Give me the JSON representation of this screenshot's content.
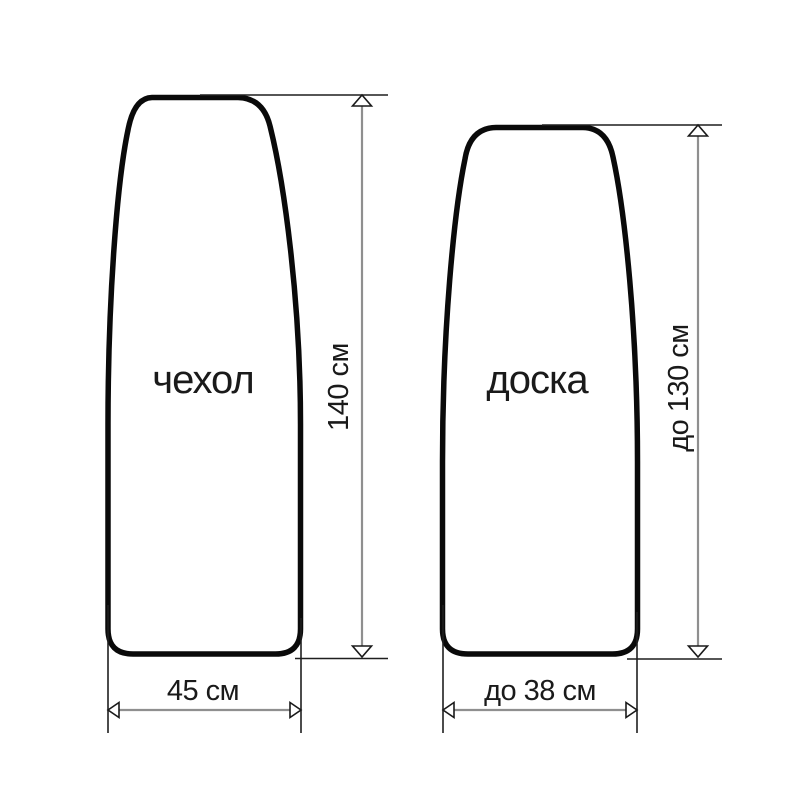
{
  "diagram": {
    "background_color": "#ffffff",
    "outline_color": "#0a0a0a",
    "dimension_line_color": "#8f8f8f",
    "extension_line_color": "#1f1f1f",
    "text_color": "#1a1a1a",
    "cover": {
      "label": "чехол",
      "height": "140 см",
      "width": "45 см"
    },
    "board": {
      "label": "доска",
      "height": "до 130 см",
      "width": "до 38 см"
    }
  }
}
